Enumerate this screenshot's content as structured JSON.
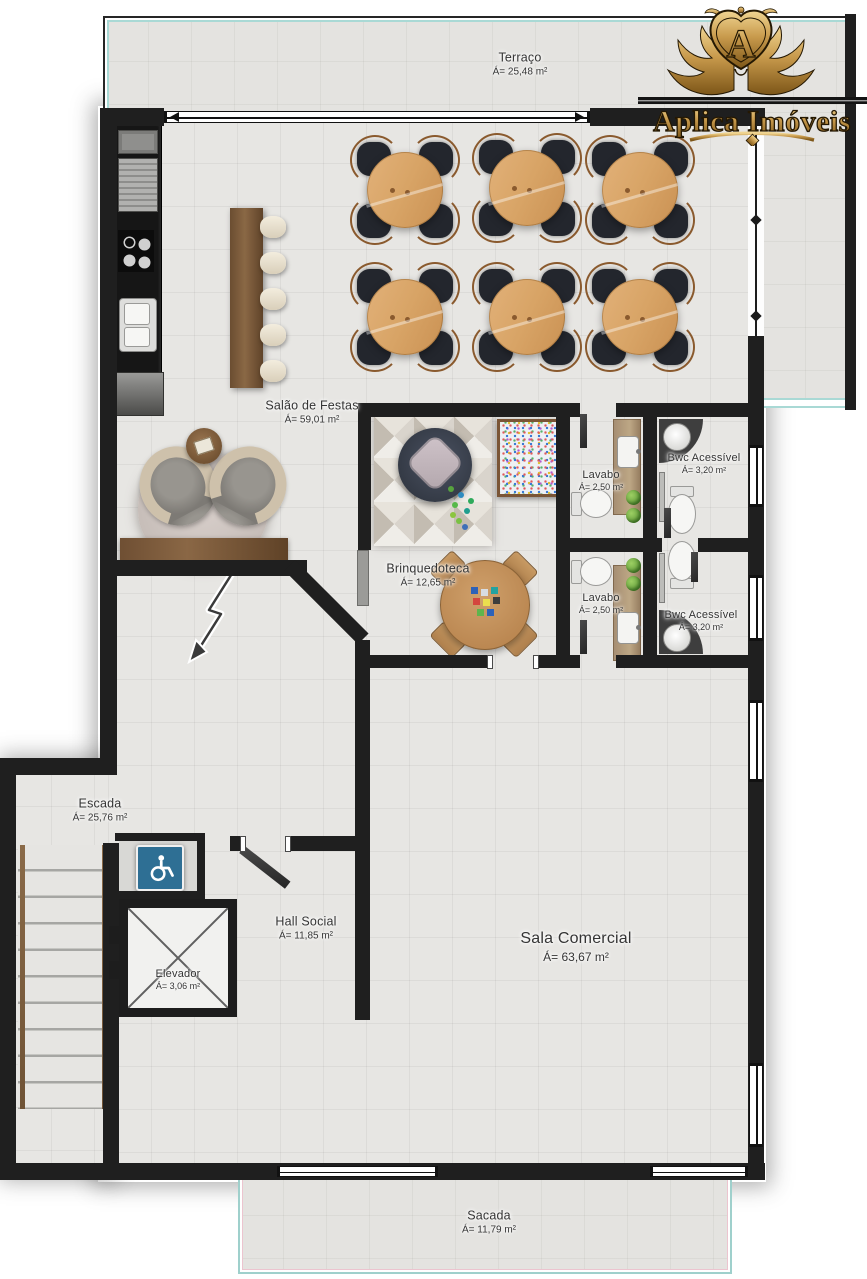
{
  "brand": {
    "name": "Aplica Imóveis",
    "monogram": "A"
  },
  "rooms": {
    "terraco": {
      "name": "Terraço",
      "area": "Á= 25,48 m²"
    },
    "salao": {
      "name": "Salão de Festas",
      "area": "Á= 59,01 m²"
    },
    "brinquedoteca": {
      "name": "Brinquedoteca",
      "area": "Á= 12,65 m²"
    },
    "lavabo1": {
      "name": "Lavabo",
      "area": "Á= 2,50 m²"
    },
    "bwc1": {
      "name": "Bwc Acessível",
      "area": "Á= 3,20 m²"
    },
    "lavabo2": {
      "name": "Lavabo",
      "area": "Á= 2,50 m²"
    },
    "bwc2": {
      "name": "Bwc Acessível",
      "area": "Á= 3,20 m²"
    },
    "escada": {
      "name": "Escada",
      "area": "Á= 25,76 m²"
    },
    "hall": {
      "name": "Hall Social",
      "area": "Á= 11,85 m²"
    },
    "elevador": {
      "name": "Elevador",
      "area": "Á= 3,06 m²"
    },
    "sala": {
      "name": "Sala Comercial",
      "area": "Á= 63,67 m²"
    },
    "sacada": {
      "name": "Sacada",
      "area": "Á= 11,79 m²"
    }
  },
  "icons": {
    "accessibility": "wheelchair"
  },
  "colors": {
    "wall": "#1f1f1f",
    "floor": "#e7e6e3",
    "accent_teal": "#a9d9d5",
    "accent_pink": "#ecc4cf",
    "wood_dark": "#7b5b3e",
    "wood_table": "#d8a466",
    "gold": "#c89a4c",
    "accessibility_blue": "#2e6f94",
    "chair_dark": "#23262d"
  }
}
